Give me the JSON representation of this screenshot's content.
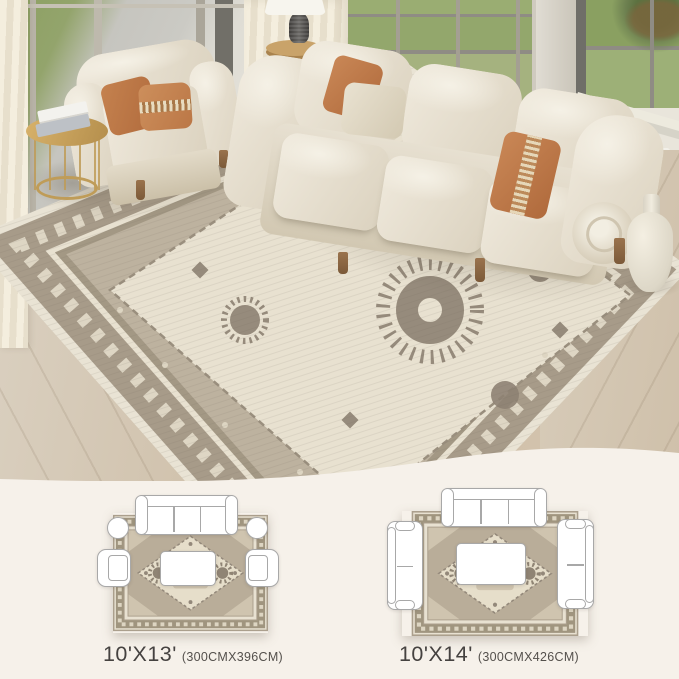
{
  "image_type": "rug product lifestyle photo with size guide",
  "photo": {
    "objects": {
      "sofa": "three-seat roll-arm sofa in cream upholstery",
      "armchair": "cream club chair",
      "pillows": "terracotta and beige accent pillows",
      "rug": "vintage medallion area rug in cream and taupe-grey",
      "side_table": "round gold metal side table with two books",
      "lamp": "table lamp with white shade and dark sculpted base",
      "vase": "cream ceramic floor vase",
      "windows": "floor-to-ceiling windows with lawn view",
      "floor": "light oak wood floor",
      "curtains": "cream curtains"
    }
  },
  "size_guide": {
    "options": [
      {
        "size": "10'X13'",
        "metric": "(300CMX396CM)",
        "furniture_layout": [
          "3-seat sofa",
          "2 round side tables",
          "2 armchairs",
          "coffee table"
        ]
      },
      {
        "size": "10'X14'",
        "metric": "(300CMX426CM)",
        "furniture_layout": [
          "3-seat sofa",
          "2 loveseats",
          "coffee table"
        ]
      }
    ]
  },
  "colors": {
    "section_background": "#f6f1ea",
    "upholstery": "#eae4d6",
    "pillow_terracotta": "#c07a4c",
    "rug_border": "#a79b89",
    "rug_field": "#bdb29f",
    "rug_panel": "#e8e1d0",
    "wood_floor": "#cfc0ab",
    "lawn_green": "#8da266",
    "metal_gold": "#bf9c58",
    "label_text": "#454240"
  }
}
